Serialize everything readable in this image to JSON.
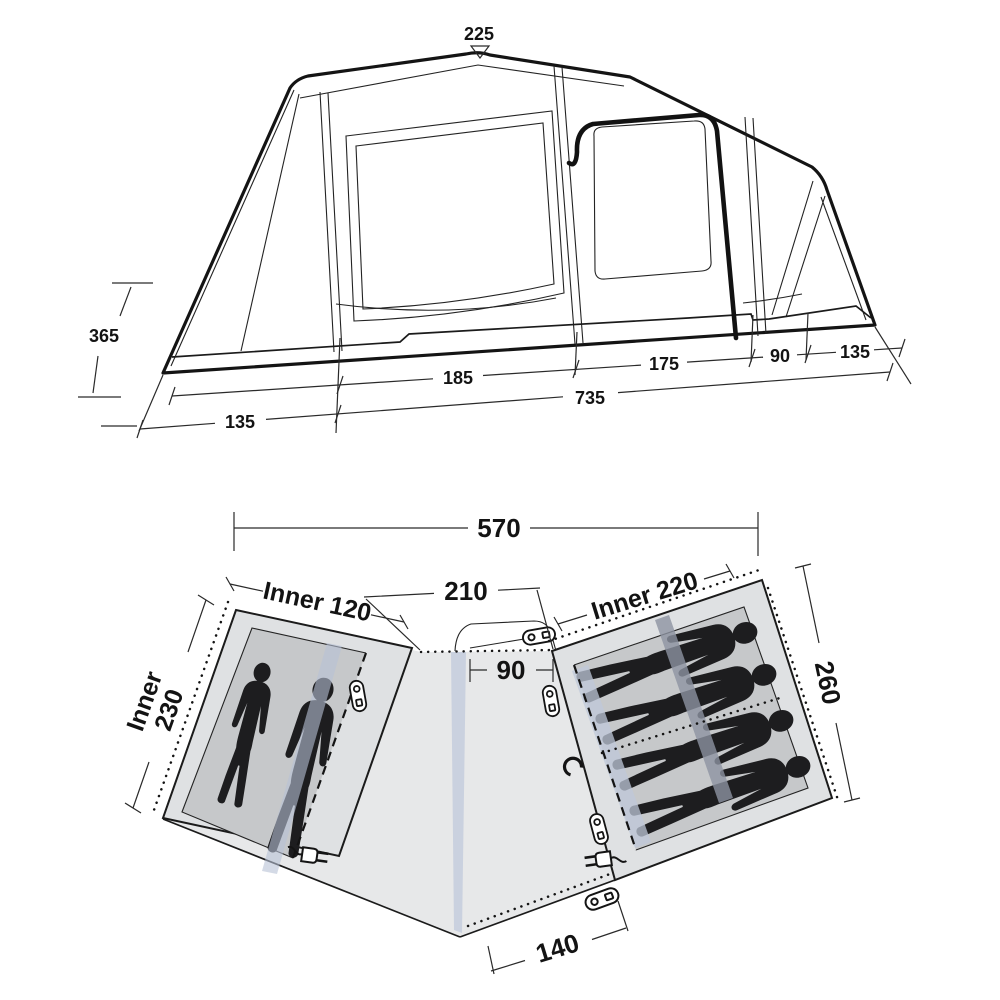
{
  "title": "Tent technical dimensions diagram",
  "side_view": {
    "peak_height": "225",
    "side_height": "365",
    "segments": {
      "s185": "185",
      "s175": "175",
      "s90": "90",
      "s135": "135"
    },
    "base": {
      "b135": "135",
      "b735": "735"
    }
  },
  "floor_plan": {
    "total_width": "570",
    "living_width": "210",
    "rear_door_width": "90",
    "front_door_width": "140",
    "left_bedroom": {
      "width_label": "Inner 120",
      "depth_label_line1": "Inner",
      "depth_label_line2": "230",
      "sleepers": 2
    },
    "right_bedroom": {
      "width_label": "Inner 220",
      "depth_label": "260",
      "sleepers": 4
    }
  },
  "colors": {
    "line": "#1a1a1a",
    "living_fill": "#e7e8e9",
    "bedroom_fill": "#dfe1e3",
    "inner_floor_fill": "#c6c8ca",
    "tube_blue": "#b7c1d6",
    "tube_gray": "#8d94a1",
    "silhouette": "#1d1d1f"
  }
}
